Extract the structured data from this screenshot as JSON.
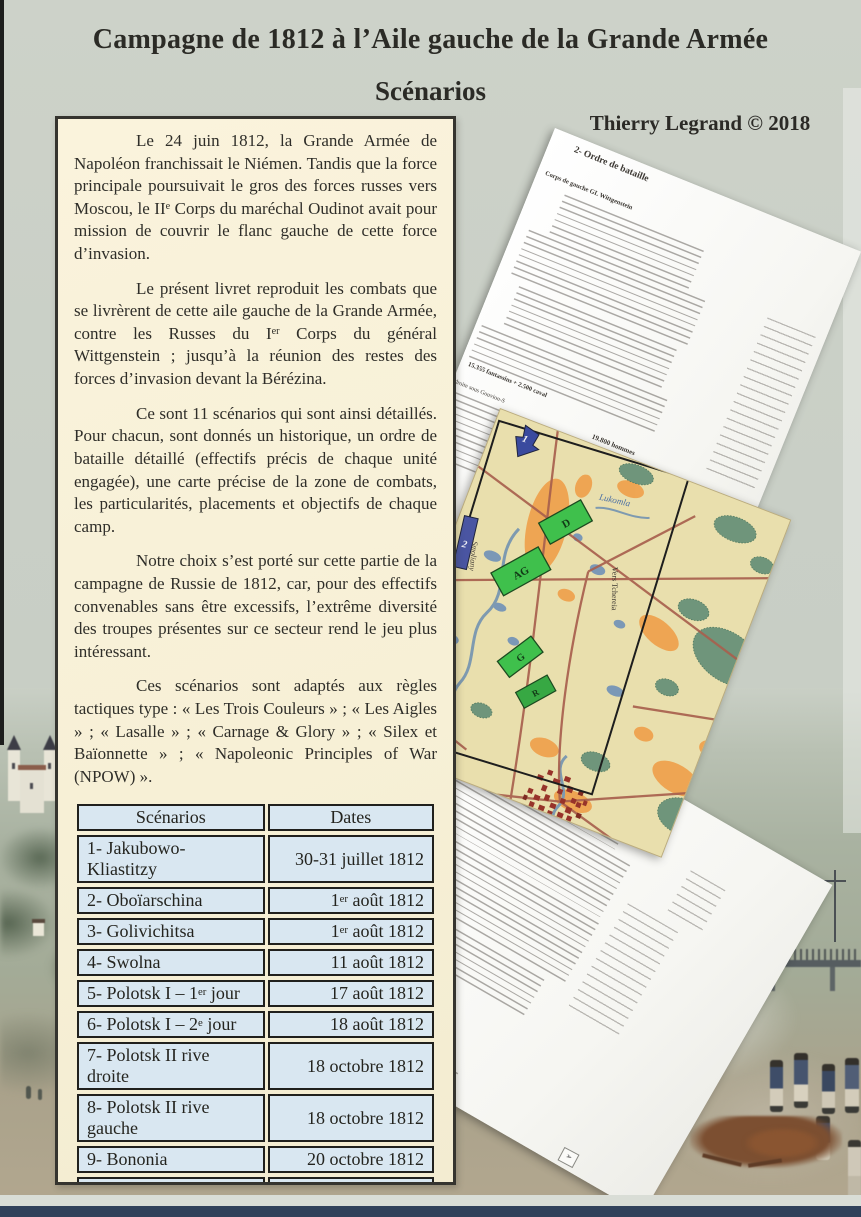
{
  "page": {
    "title": "Campagne de 1812 à l’Aile gauche de la Grande Armée",
    "subtitle": "Scénarios",
    "credit": "Thierry Legrand © 2018"
  },
  "intro": {
    "paragraphs": {
      "p1": "Le 24 juin 1812, la Grande Armée de Napoléon franchissait le Niémen. Tandis que la force principale poursuivait le gros des forces russes vers Moscou, le II[sup]e[/sup] Corps du maréchal Oudinot avait pour mission de couvrir le flanc gauche de cette force d’invasion.",
      "p2": "Le présent livret reproduit les combats que se livrèrent de cette aile gauche de la Grande Armée, contre les Russes du I[sup]er[/sup] Corps du général Wittgenstein ; jusqu’à la réunion des restes des forces d’invasion devant la Bérézina.",
      "p3": "Ce sont 11 scénarios qui sont ainsi détaillés. Pour chacun, sont donnés un historique, un ordre de bataille détaillé (effectifs précis de chaque unité engagée), une carte précise de la zone de combats, les particularités, placements et objectifs de chaque camp.",
      "p4": "Notre choix s’est porté sur cette partie de la campagne de Russie de 1812, car, pour des effectifs convenables sans être excessifs, l’extrême diversité des troupes présentes sur ce secteur rend le jeu plus intéressant.",
      "p5": "Ces scénarios sont adaptés aux règles tactiques type : « Les Trois Couleurs » ; « Les Aigles » ; « Lasalle » ; « Carnage & Glory » ; « Silex et Baïonnette » ; « Napoleonic Principles of War (NPOW) »."
    }
  },
  "table": {
    "headers": {
      "scenario": "Scénarios",
      "date": "Dates"
    },
    "rows": [
      {
        "scenario": "1- Jakubowo-Kliastitzy",
        "date": "30-31 juillet 1812"
      },
      {
        "scenario": "2- Oboïarschina",
        "date": "1[sup]er[/sup] août 1812"
      },
      {
        "scenario": "3- Golivichitsa",
        "date": "1[sup]er[/sup] août 1812"
      },
      {
        "scenario": "4- Swolna",
        "date": "11 août 1812"
      },
      {
        "scenario": "5- Polotsk I – 1[sup]er[/sup] jour",
        "date": "17 août 1812"
      },
      {
        "scenario": "6- Polotsk I – 2[sup]e[/sup] jour",
        "date": "18 août 1812"
      },
      {
        "scenario": "7- Polotsk II rive droite",
        "date": "18 octobre 1812"
      },
      {
        "scenario": "8- Polotsk II rive gauche",
        "date": "18 octobre 1812"
      },
      {
        "scenario": "9- Bononia",
        "date": "20 octobre 1812"
      },
      {
        "scenario": "10- Czarnicki",
        "date": "31 octobre 1812"
      },
      {
        "scenario": "11- Smoliany",
        "date": "14 novembre 1812"
      }
    ]
  },
  "documents": {
    "order_of_battle_top": {
      "title": "2- Ordre de bataille",
      "subtitle": "Corps de gauche GL Wittgenstein",
      "totals_left": "15.355 fantassins + 2.500 caval",
      "fragment_wing": "droite sous Gouvion-S",
      "totals_bottom": "19.800 hommes"
    },
    "order_of_battle_bottom": {
      "fragment_division": "Saint-Cyr",
      "fragment_totals": "31.455 fantassins + 3.960 cavaliers = 118 canons",
      "fragment_heading": "du scénario"
    }
  },
  "map": {
    "units": {
      "arrow": "1",
      "bar": "2",
      "d": "D",
      "ag": "AG",
      "g": "G",
      "r": "R"
    },
    "labels": {
      "river": "Lukomla",
      "road": "Vers Tchereia",
      "village": "Smoliany"
    }
  },
  "colors": {
    "page_bg": "#c9cfc6",
    "box_bg": "#f7f0d6",
    "box_border": "#35342f",
    "table_cell_bg": "#d9e7f1",
    "map_bg": "#e9dfad",
    "unit_green": "#3fc04c",
    "unit_blue": "#4a55a2",
    "bottom_strip_navy": "#30415a"
  }
}
